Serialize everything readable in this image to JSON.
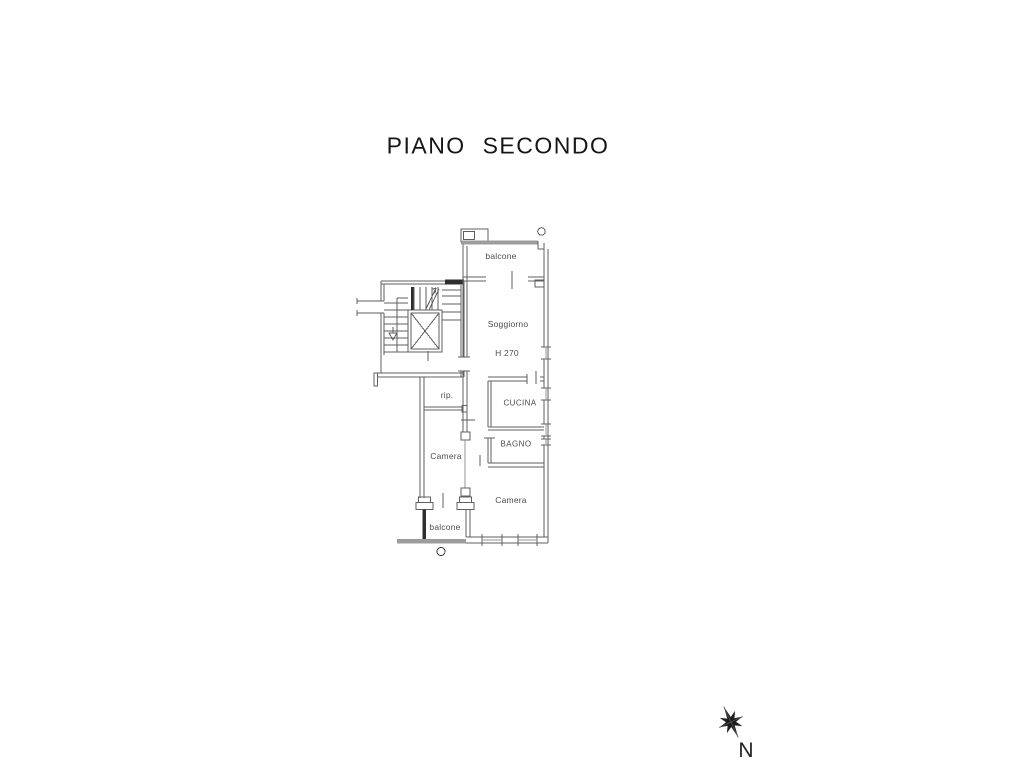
{
  "title": {
    "text": "PIANO SECONDO"
  },
  "floor_plan": {
    "rooms": [
      {
        "id": "balcone-top",
        "label": "balcone"
      },
      {
        "id": "soggiorno",
        "label": "Soggiorno"
      },
      {
        "id": "soggiorno-height",
        "label": "H 270"
      },
      {
        "id": "ripostiglio",
        "label": "rip."
      },
      {
        "id": "cucina",
        "label": "CUCINA"
      },
      {
        "id": "bagno",
        "label": "BAGNO"
      },
      {
        "id": "camera-left",
        "label": "Camera"
      },
      {
        "id": "camera-right",
        "label": "Camera"
      },
      {
        "id": "balcone-bottom",
        "label": "balcone"
      }
    ]
  },
  "compass": {
    "label": "N"
  },
  "colors": {
    "wall_line": "#5f5f5f",
    "light_line": "#949494",
    "dark_fill": "#2e2e2e",
    "railing": "#9c9c9c",
    "label_text": "#4c4c4c",
    "title_text": "#161616"
  }
}
